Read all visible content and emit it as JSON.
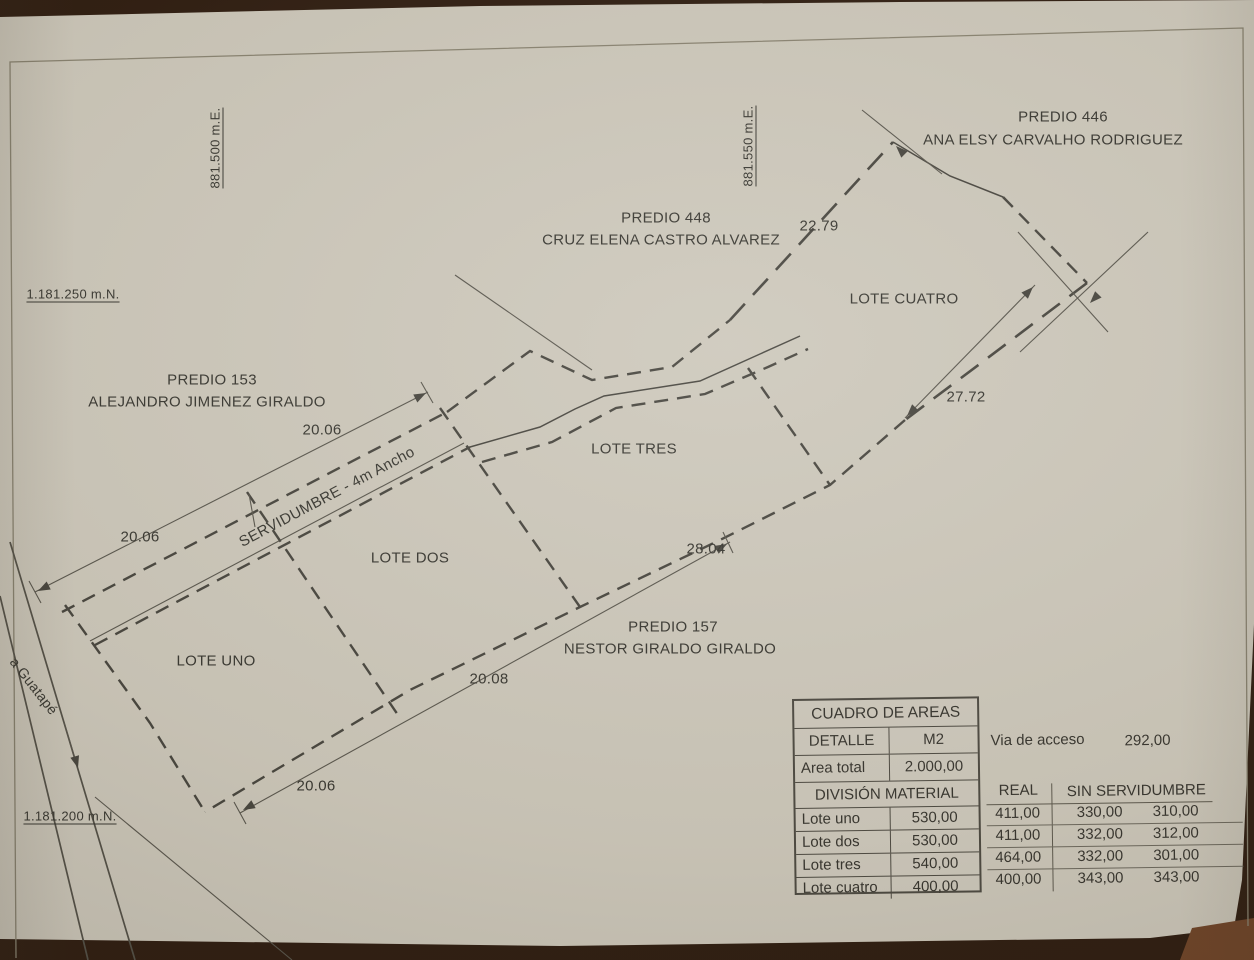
{
  "photo": {
    "wood_dark": "#2c1a0e",
    "wood_light": "#6e4226",
    "paper_color": "#ccc7ba",
    "ink_color": "#45433c"
  },
  "plan": {
    "labels": [
      {
        "id": "predio-446-number",
        "text": "PREDIO 446",
        "x": 1063,
        "y": 117,
        "size": 15
      },
      {
        "id": "predio-446-owner",
        "text": "ANA ELSY CARVALHO RODRIGUEZ",
        "x": 1053,
        "y": 140,
        "size": 15
      },
      {
        "id": "predio-448-number",
        "text": "PREDIO 448",
        "x": 666,
        "y": 218,
        "size": 15
      },
      {
        "id": "predio-448-owner",
        "text": "CRUZ ELENA CASTRO ALVAREZ",
        "x": 661,
        "y": 240,
        "size": 15
      },
      {
        "id": "dim-22-79",
        "text": "22.79",
        "x": 819,
        "y": 226,
        "size": 15
      },
      {
        "id": "lote-cuatro",
        "text": "LOTE CUATRO",
        "x": 904,
        "y": 299,
        "size": 15
      },
      {
        "id": "dim-27-72",
        "text": "27.72",
        "x": 966,
        "y": 397,
        "size": 15
      },
      {
        "id": "coord-e-881500",
        "text": "881.500 m.E.",
        "x": 215,
        "y": 148,
        "size": 13,
        "rot": -90,
        "u": true
      },
      {
        "id": "coord-e-881550",
        "text": "881.550 m.E.",
        "x": 748,
        "y": 146,
        "size": 13,
        "rot": -90,
        "u": true
      },
      {
        "id": "coord-n-1181250",
        "text": "1.181.250 m.N.",
        "x": 73,
        "y": 294,
        "size": 13,
        "u": true
      },
      {
        "id": "predio-153-number",
        "text": "PREDIO 153",
        "x": 212,
        "y": 380,
        "size": 15
      },
      {
        "id": "predio-153-owner",
        "text": "ALEJANDRO JIMENEZ GIRALDO",
        "x": 207,
        "y": 402,
        "size": 15
      },
      {
        "id": "dim-20-06-top",
        "text": "20.06",
        "x": 322,
        "y": 430,
        "size": 15
      },
      {
        "id": "dim-20-06-left",
        "text": "20.06",
        "x": 140,
        "y": 537,
        "size": 15
      },
      {
        "id": "servidumbre",
        "text": "SERVIDUMBRE - 4m Ancho",
        "x": 327,
        "y": 497,
        "size": 15,
        "rot": -28
      },
      {
        "id": "lote-tres",
        "text": "LOTE TRES",
        "x": 634,
        "y": 449,
        "size": 15
      },
      {
        "id": "lote-dos",
        "text": "LOTE DOS",
        "x": 410,
        "y": 558,
        "size": 15
      },
      {
        "id": "dim-28-04",
        "text": "28.04",
        "x": 706,
        "y": 549,
        "size": 15
      },
      {
        "id": "predio-157-number",
        "text": "PREDIO 157",
        "x": 673,
        "y": 627,
        "size": 15
      },
      {
        "id": "predio-157-owner",
        "text": "NESTOR GIRALDO GIRALDO",
        "x": 670,
        "y": 649,
        "size": 15
      },
      {
        "id": "lote-uno",
        "text": "LOTE UNO",
        "x": 216,
        "y": 661,
        "size": 15
      },
      {
        "id": "dim-20-08",
        "text": "20.08",
        "x": 489,
        "y": 679,
        "size": 15
      },
      {
        "id": "dim-20-06-bottom",
        "text": "20.06",
        "x": 316,
        "y": 786,
        "size": 15
      },
      {
        "id": "road-guatape",
        "text": "a Guatapé",
        "x": 34,
        "y": 686,
        "size": 14,
        "rot": 52
      },
      {
        "id": "coord-n-1181200",
        "text": "1.181.200 m.N.",
        "x": 70,
        "y": 816,
        "size": 13,
        "u": true
      }
    ],
    "lines": [
      {
        "name": "servidumbre-dim-line",
        "cls": "thin",
        "pts": [
          [
            35,
            592
          ],
          [
            428,
            392
          ]
        ]
      },
      {
        "name": "dim-tick-west",
        "cls": "thin",
        "pts": [
          [
            29,
            581
          ],
          [
            41,
            603
          ]
        ]
      },
      {
        "name": "dim-tick-east",
        "cls": "thin",
        "pts": [
          [
            421,
            382
          ],
          [
            433,
            403
          ]
        ]
      },
      {
        "name": "servidumbre-north-edge",
        "cls": "dash",
        "pts": [
          [
            62,
            612
          ],
          [
            447,
            412
          ]
        ]
      },
      {
        "name": "servidumbre-south-edge",
        "cls": "dash",
        "pts": [
          [
            95,
            645
          ],
          [
            470,
            447
          ]
        ]
      },
      {
        "name": "servidumbre-inner-line",
        "cls": "thin",
        "pts": [
          [
            90,
            641
          ],
          [
            464,
            443
          ]
        ]
      },
      {
        "name": "north-boundary-zigzag",
        "cls": "dash",
        "pts": [
          [
            447,
            412
          ],
          [
            530,
            351
          ],
          [
            592,
            380
          ],
          [
            672,
            367
          ],
          [
            730,
            320
          ]
        ]
      },
      {
        "name": "boundary-22-79",
        "cls": "dashlong",
        "pts": [
          [
            730,
            320
          ],
          [
            893,
            142
          ]
        ]
      },
      {
        "name": "north-boundary-top-right",
        "cls": "solid",
        "pts": [
          [
            893,
            142
          ],
          [
            950,
            176
          ],
          [
            1003,
            197
          ]
        ]
      },
      {
        "name": "boundary-to-east-corner",
        "cls": "dash",
        "pts": [
          [
            1003,
            197
          ],
          [
            1087,
            283
          ]
        ]
      },
      {
        "name": "southeast-boundary-cuatro",
        "cls": "dashlong",
        "pts": [
          [
            1087,
            283
          ],
          [
            985,
            360
          ],
          [
            905,
            420
          ]
        ]
      },
      {
        "name": "south-boundary",
        "cls": "dash",
        "pts": [
          [
            905,
            420
          ],
          [
            830,
            485
          ],
          [
            720,
            540
          ],
          [
            580,
            607
          ],
          [
            410,
            690
          ],
          [
            205,
            812
          ]
        ]
      },
      {
        "name": "west-boundary-road-side",
        "cls": "dash",
        "pts": [
          [
            65,
            605
          ],
          [
            150,
            723
          ],
          [
            205,
            812
          ]
        ]
      },
      {
        "name": "divider-lote-uno-dos",
        "cls": "dash",
        "pts": [
          [
            247,
            492
          ],
          [
            400,
            718
          ]
        ]
      },
      {
        "name": "divider-lote-dos-tres",
        "cls": "dash",
        "pts": [
          [
            440,
            408
          ],
          [
            580,
            607
          ]
        ]
      },
      {
        "name": "divider-lote-tres-cuatro",
        "cls": "dash",
        "pts": [
          [
            748,
            368
          ],
          [
            830,
            485
          ]
        ]
      },
      {
        "name": "servidumbre-curve-solid",
        "cls": "solid",
        "pts": [
          [
            470,
            447
          ],
          [
            540,
            427
          ],
          [
            575,
            409
          ],
          [
            604,
            396
          ],
          [
            700,
            381
          ],
          [
            760,
            354
          ],
          [
            800,
            336
          ]
        ]
      },
      {
        "name": "servidumbre-curve-dashed",
        "cls": "dash",
        "pts": [
          [
            482,
            462
          ],
          [
            552,
            442
          ],
          [
            586,
            424
          ],
          [
            616,
            408
          ],
          [
            705,
            394
          ],
          [
            768,
            367
          ],
          [
            808,
            349
          ]
        ]
      },
      {
        "name": "south-dim-line",
        "cls": "thin",
        "pts": [
          [
            240,
            813
          ],
          [
            730,
            542
          ]
        ]
      },
      {
        "name": "south-dim-tick-west",
        "cls": "thin",
        "pts": [
          [
            234,
            802
          ],
          [
            246,
            824
          ]
        ]
      },
      {
        "name": "south-dim-tick-east",
        "cls": "thin",
        "pts": [
          [
            723,
            532
          ],
          [
            733,
            553
          ]
        ]
      },
      {
        "name": "dim-line-27-72",
        "cls": "thin",
        "pts": [
          [
            905,
            418
          ],
          [
            1035,
            285
          ]
        ]
      },
      {
        "name": "survey-line-crossing",
        "cls": "thin",
        "pts": [
          [
            455,
            275
          ],
          [
            592,
            370
          ]
        ]
      },
      {
        "name": "survey-line-peak",
        "cls": "thin",
        "pts": [
          [
            862,
            110
          ],
          [
            942,
            174
          ]
        ]
      },
      {
        "name": "survey-line-east-1",
        "cls": "thin",
        "pts": [
          [
            1018,
            232
          ],
          [
            1108,
            332
          ]
        ]
      },
      {
        "name": "survey-line-east-2",
        "cls": "thin",
        "pts": [
          [
            1148,
            232
          ],
          [
            1020,
            352
          ]
        ]
      },
      {
        "name": "survey-line-bottom-left",
        "cls": "thin",
        "pts": [
          [
            95,
            797
          ],
          [
            292,
            960
          ]
        ]
      },
      {
        "name": "divider-tick",
        "cls": "thin",
        "pts": [
          [
            249,
            494
          ],
          [
            255,
            527
          ]
        ]
      },
      {
        "name": "road-line-west",
        "cls": "road",
        "pts": [
          [
            0,
            596
          ],
          [
            88,
            960
          ]
        ]
      },
      {
        "name": "road-line-east",
        "cls": "road",
        "pts": [
          [
            10,
            542
          ],
          [
            135,
            960
          ]
        ]
      },
      {
        "name": "road-arrow-shaft",
        "cls": "thin",
        "pts": [
          [
            64,
            722
          ],
          [
            76,
            762
          ]
        ]
      }
    ],
    "arrows": [
      {
        "x": 426,
        "y": 393,
        "rot": -27
      },
      {
        "x": 38,
        "y": 591,
        "rot": 153
      },
      {
        "x": 243,
        "y": 810,
        "rot": 151
      },
      {
        "x": 727,
        "y": 544,
        "rot": -29
      },
      {
        "x": 907,
        "y": 416,
        "rot": 134
      },
      {
        "x": 1033,
        "y": 287,
        "rot": -46
      },
      {
        "x": 896,
        "y": 146,
        "rot": -135
      },
      {
        "x": 1090,
        "y": 303,
        "rot": 134
      },
      {
        "x": 78,
        "y": 768,
        "rot": 74
      }
    ]
  },
  "areas_table": {
    "title": "CUADRO DE AREAS",
    "col_headers": [
      "DETALLE",
      "M2"
    ],
    "total_row": [
      "Area total",
      "2.000,00"
    ],
    "division_header": "DIVISIÓN MATERIAL",
    "right_headers": [
      "REAL",
      "SIN SERVIDUMBRE"
    ],
    "via": {
      "label": "Via de acceso",
      "value": "292,00"
    },
    "rows": [
      {
        "name": "Lote uno",
        "m2": "530,00",
        "real": "411,00",
        "sin1": "330,00",
        "sin2": "310,00"
      },
      {
        "name": "Lote dos",
        "m2": "530,00",
        "real": "411,00",
        "sin1": "332,00",
        "sin2": "312,00"
      },
      {
        "name": "Lote tres",
        "m2": "540,00",
        "real": "464,00",
        "sin1": "332,00",
        "sin2": "301,00"
      },
      {
        "name": "Lote cuatro",
        "m2": "400,00",
        "real": "400,00",
        "sin1": "343,00",
        "sin2": "343,00"
      }
    ]
  }
}
